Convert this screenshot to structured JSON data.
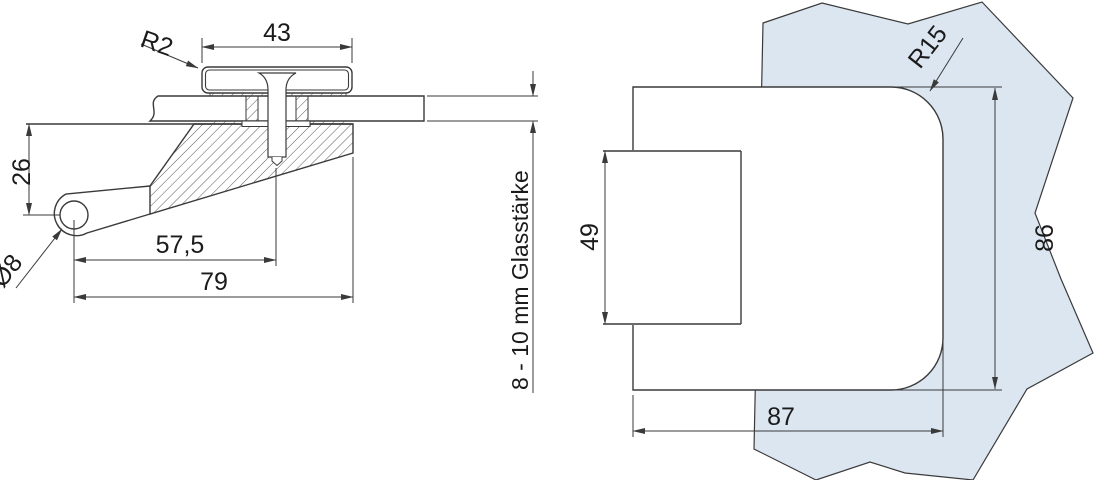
{
  "drawing": {
    "line_color": "#3a3a3a",
    "glass_color": "#dbe6f1",
    "left_view": {
      "cap_width": "43",
      "cap_radius": "R2",
      "lug_height": "26",
      "hole_diameter": "Ø8",
      "screw_offset": "57,5",
      "total_length": "79",
      "glass_thickness": "8 - 10 mm Glasstärke"
    },
    "right_view": {
      "corner_radius": "R15",
      "boss_height": "49",
      "body_height": "86",
      "body_width": "87"
    }
  }
}
